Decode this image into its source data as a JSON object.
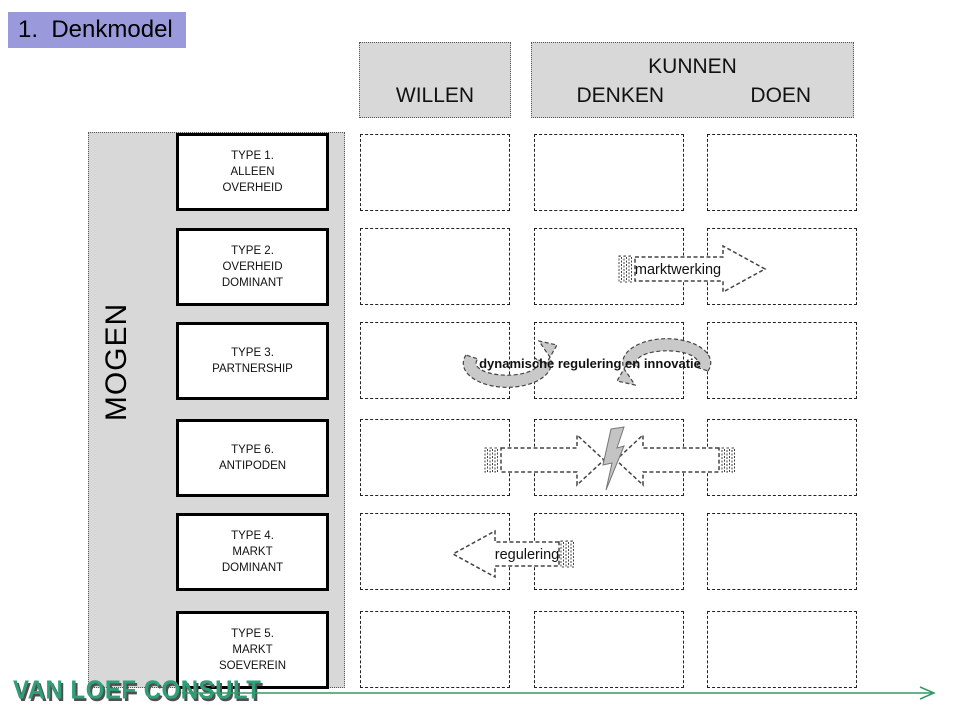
{
  "slide": {
    "title": "1.  Denkmodel",
    "columns": {
      "willen": "WILLEN",
      "kunnen": "KUNNEN",
      "denken": "DENKEN",
      "doen": "DOEN"
    },
    "row_axis": "MOGEN",
    "type_boxes": [
      {
        "label": "TYPE 1.\nALLEEN\nOVERHEID"
      },
      {
        "label": "TYPE 2.\nOVERHEID\nDOMINANT"
      },
      {
        "label": "TYPE 3.\nPARTNERSHIP"
      },
      {
        "label": "TYPE 6.\nANTIPODEN"
      },
      {
        "label": "TYPE 4.\nMARKT\nDOMINANT"
      },
      {
        "label": "TYPE 5.\nMARKT\nSOEVEREIN"
      }
    ],
    "grid": {
      "rows": 6,
      "cols": 3,
      "cells_empty": true
    },
    "annotations": {
      "marktwerking": "marktwerking",
      "dynamische": "dynamische regulering en innovatie",
      "regulering": "regulering"
    },
    "logo": "VAN LOEF CONSULT",
    "colors": {
      "title_bg": "#9999db",
      "header_bg": "#d8d8d8",
      "shape_gray": "#c9c9c9",
      "line_green": "#339966",
      "logo_green": "#2f9f7a"
    }
  }
}
